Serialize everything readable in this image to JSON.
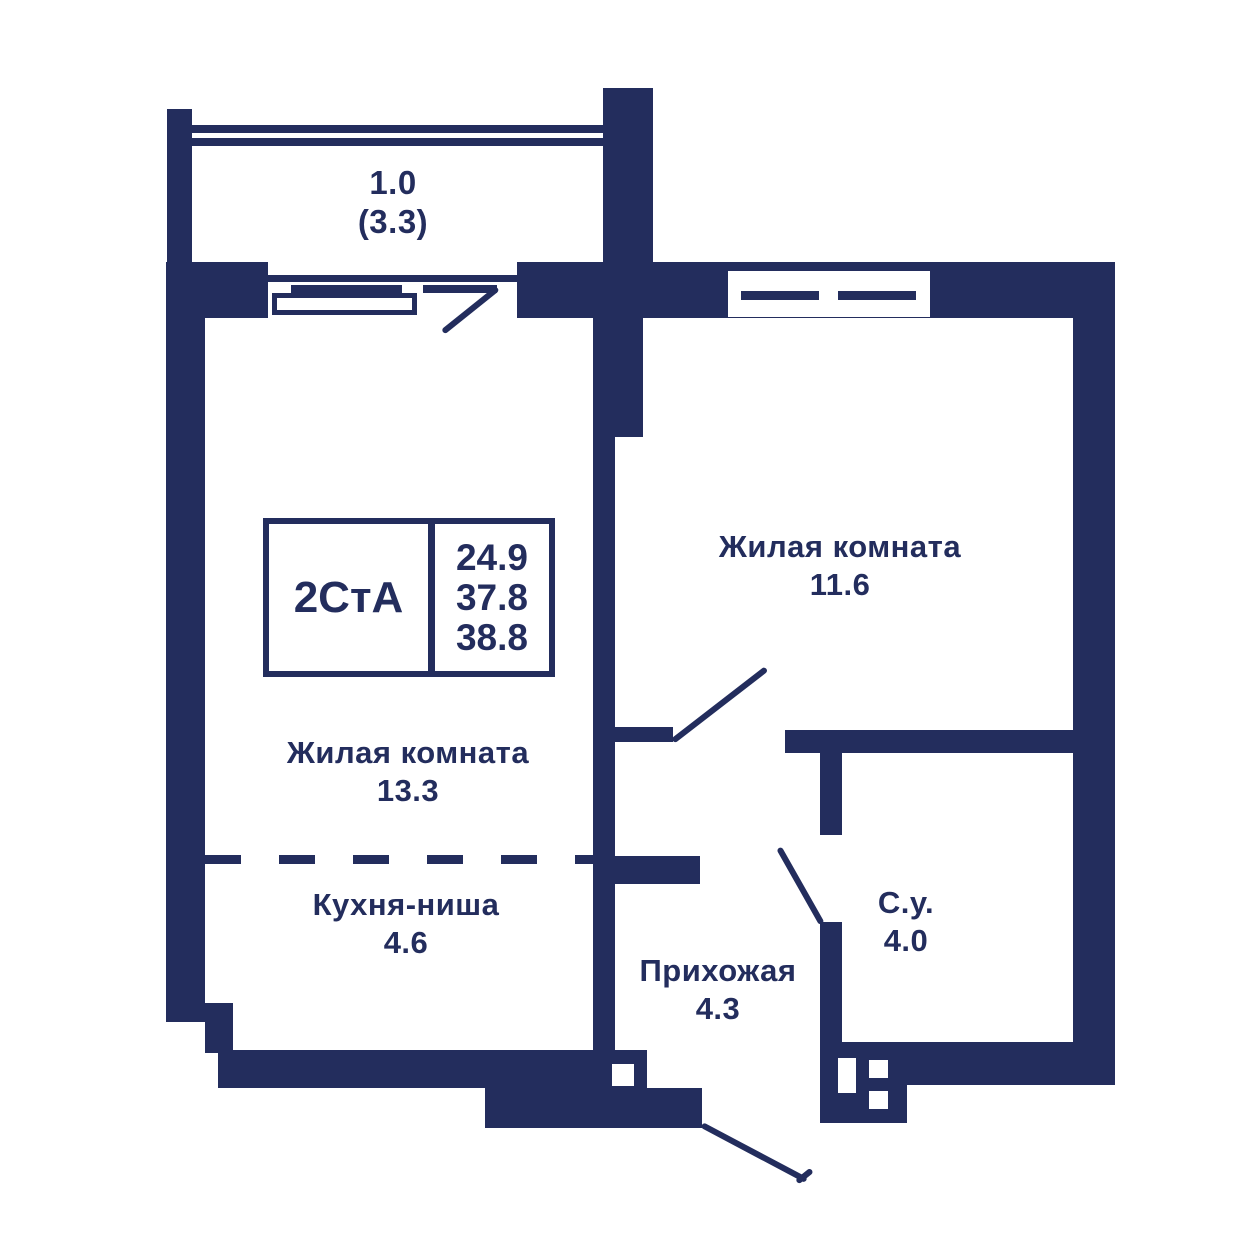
{
  "colors": {
    "wall": "#232d5d",
    "background": "#ffffff"
  },
  "stats_box": {
    "type_label": "2СтА",
    "values": [
      "24.9",
      "37.8",
      "38.8"
    ]
  },
  "balcony": {
    "coefficient_area": "1.0",
    "full_area": "(3.3)"
  },
  "rooms": [
    {
      "name": "Жилая комната",
      "area": "11.6"
    },
    {
      "name": "Жилая комната",
      "area": "13.3"
    },
    {
      "name": "Кухня-ниша",
      "area": "4.6"
    },
    {
      "name": "Прихожая",
      "area": "4.3"
    },
    {
      "name": "С.у.",
      "area": "4.0"
    }
  ]
}
